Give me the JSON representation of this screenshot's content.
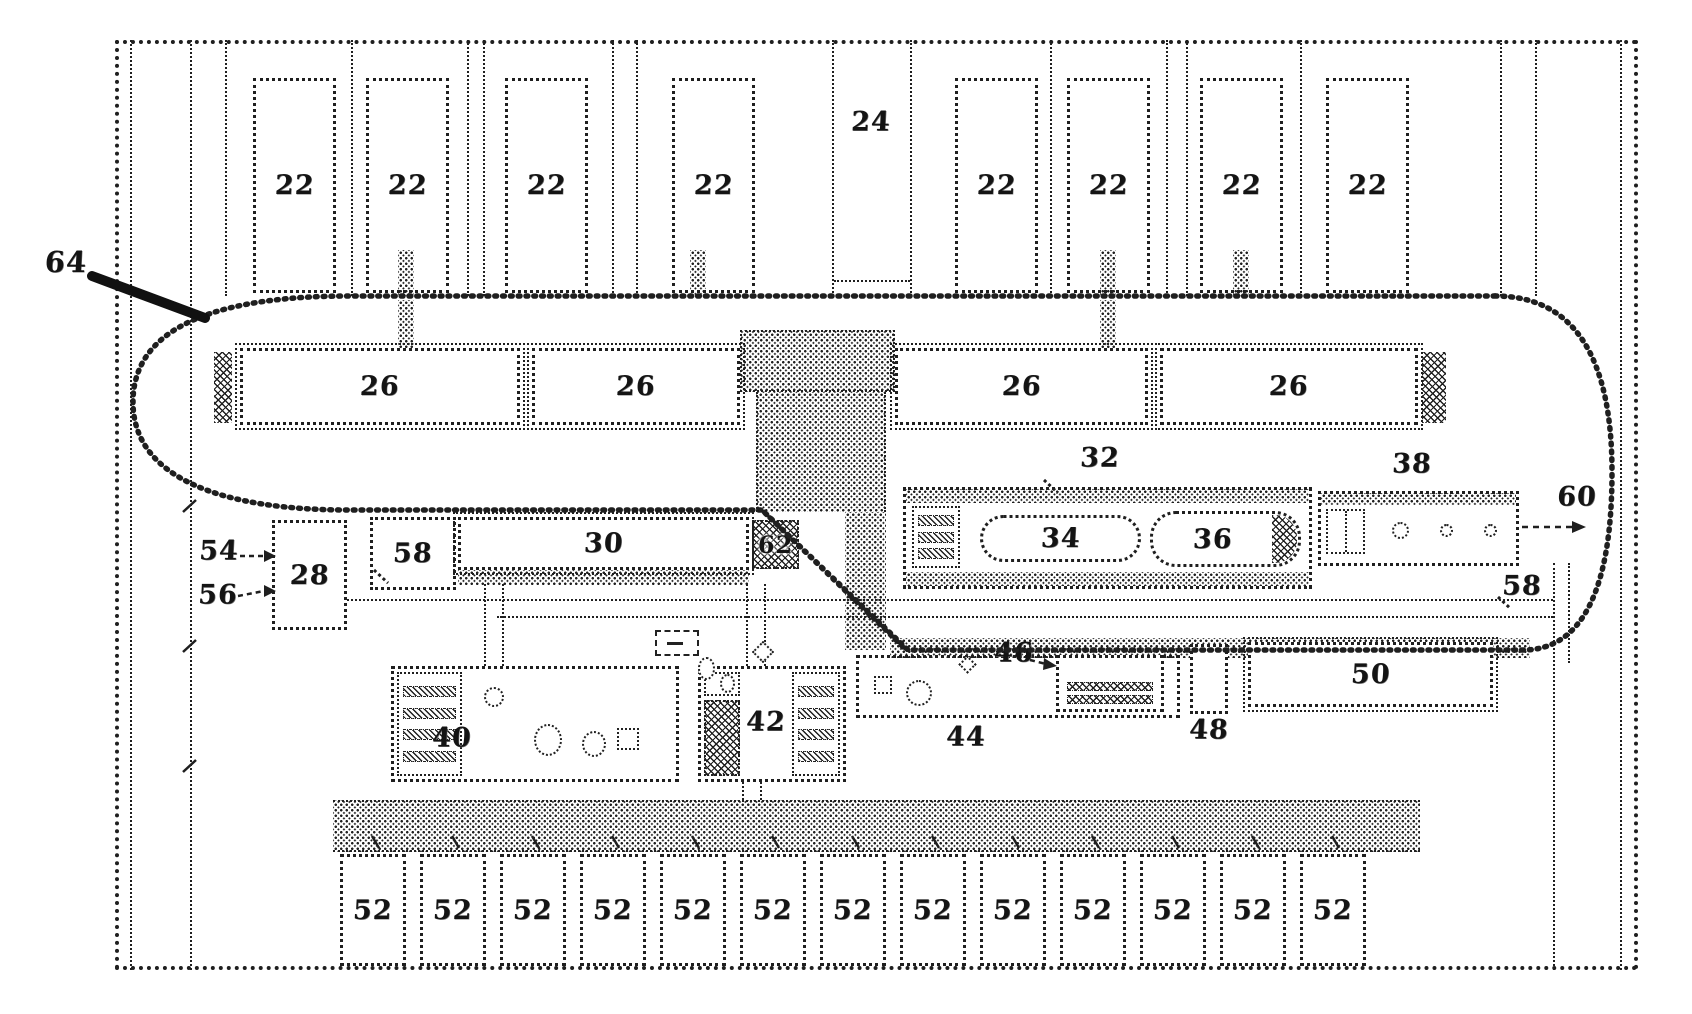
{
  "figure_labels": {
    "top_bays": [
      "22",
      "22",
      "22",
      "22",
      "22",
      "22",
      "22",
      "22"
    ],
    "center_aisle": "24",
    "stockers": [
      "26",
      "26",
      "26",
      "26"
    ],
    "loop": "64",
    "m28": "28",
    "m30": "30",
    "m32": "32",
    "m34": "34",
    "m36": "36",
    "m38": "38",
    "m40": "40",
    "m42": "42",
    "m44": "44",
    "m46": "46",
    "m48": "48",
    "m50": "50",
    "m58a": "58",
    "m58b": "58",
    "m60": "60",
    "m62": "62",
    "c54": "54",
    "c56": "56",
    "bottom_bays": [
      "52",
      "52",
      "52",
      "52",
      "52",
      "52",
      "52",
      "52",
      "52",
      "52",
      "52",
      "52",
      "52"
    ]
  },
  "colors": {
    "ink": "#1f1f1f",
    "paper": "#ffffff"
  }
}
